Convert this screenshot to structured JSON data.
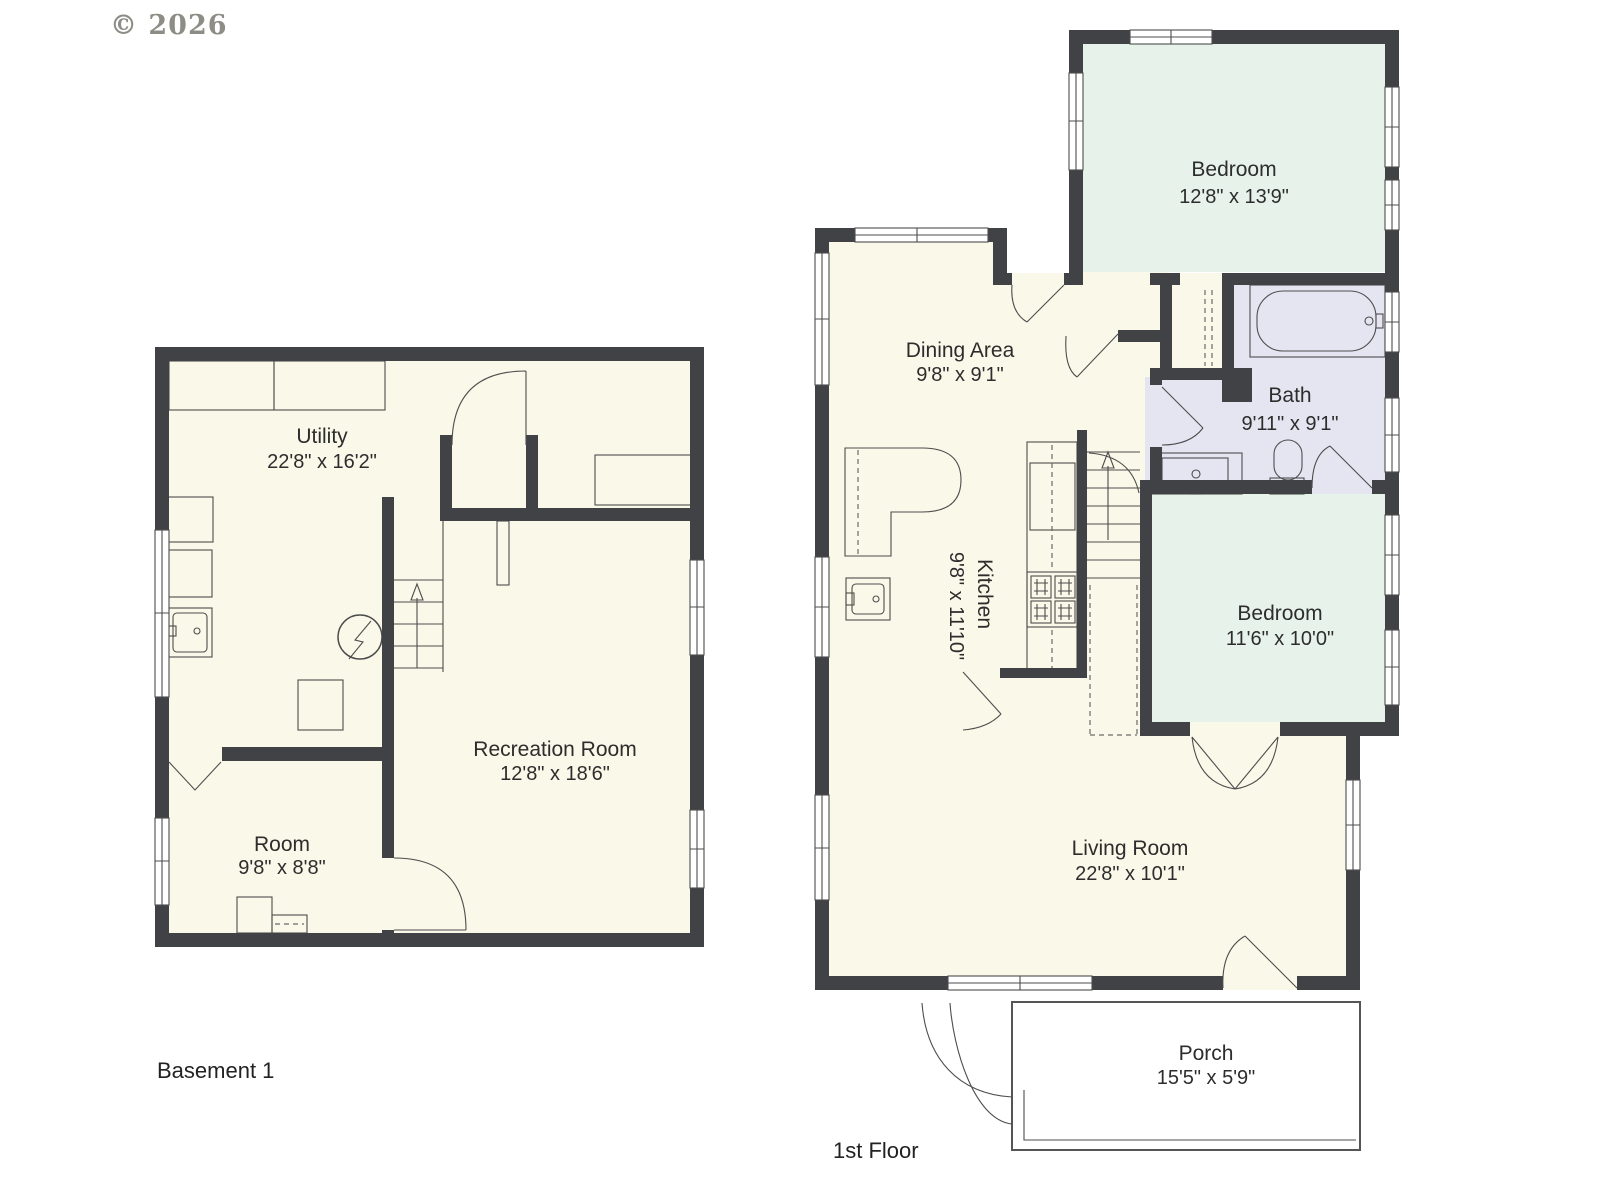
{
  "copyright": "© 2026",
  "colors": {
    "wall": "#414245",
    "room_cream": "#FAF8E9",
    "bedroom_green": "#E7F3EA",
    "bath_lavender": "#E5E5F2",
    "line": "#4d4d4d",
    "label": "#2d2d2d",
    "copyright_gray": "#8d8d86"
  },
  "floors": [
    {
      "label": "Basement 1",
      "rooms": [
        {
          "name": "Utility",
          "dims": "22'8\" x 16'2\""
        },
        {
          "name": "Room",
          "dims": "9'8\" x 8'8\""
        },
        {
          "name": "Recreation Room",
          "dims": "12'8\" x 18'6\""
        }
      ]
    },
    {
      "label": "1st Floor",
      "rooms": [
        {
          "name": "Bedroom",
          "dims": "12'8\" x 13'9\""
        },
        {
          "name": "Dining Area",
          "dims": "9'8\" x 9'1\""
        },
        {
          "name": "Bath",
          "dims": "9'11\" x 9'1\""
        },
        {
          "name": "Kitchen",
          "dims": "9'8\" x 11'10\""
        },
        {
          "name": "Bedroom",
          "dims": "11'6\" x 10'0\""
        },
        {
          "name": "Living Room",
          "dims": "22'8\" x 10'1\""
        },
        {
          "name": "Porch",
          "dims": "15'5\" x 5'9\""
        }
      ]
    }
  ]
}
